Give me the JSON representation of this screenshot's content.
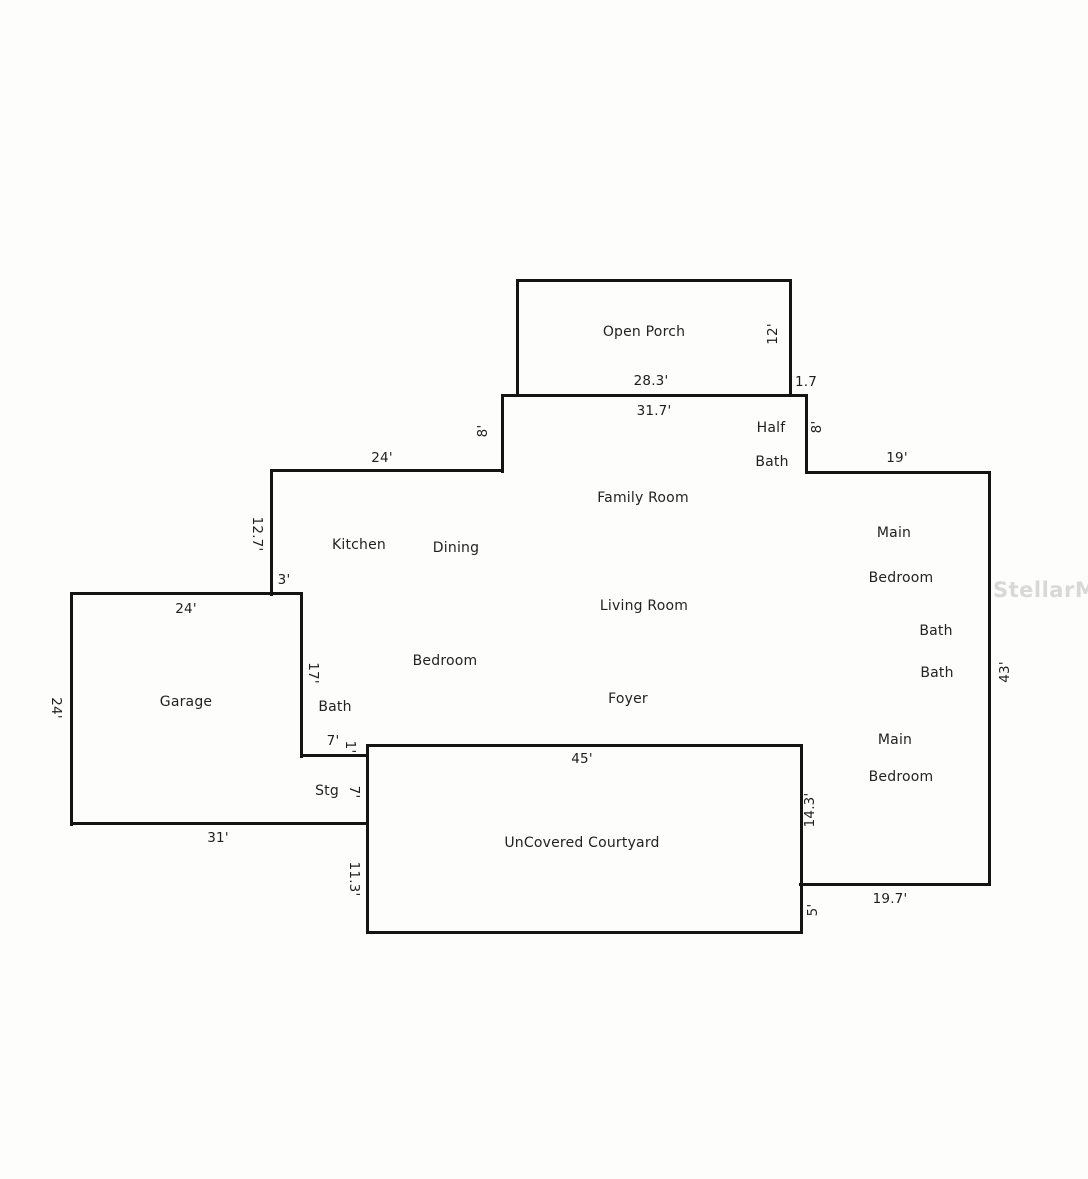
{
  "watermark": "StellarMLS",
  "rooms": {
    "open_porch": "Open Porch",
    "half_bath": [
      "Half",
      "Bath"
    ],
    "family_room": "Family Room",
    "kitchen": "Kitchen",
    "dining": "Dining",
    "living_room": "Living Room",
    "main_bedroom_upper": [
      "Main",
      "Bedroom"
    ],
    "bath_upper": "Bath",
    "bath_lower": "Bath",
    "bedroom": "Bedroom",
    "garage": "Garage",
    "bath_garage": "Bath",
    "foyer": "Foyer",
    "stg": "Stg",
    "main_bedroom_lower": [
      "Main",
      "Bedroom"
    ],
    "courtyard": "UnCovered Courtyard"
  },
  "dims": {
    "porch_width": "28.3'",
    "porch_depth": "12'",
    "porch_offset": "1.7",
    "house_top_width": "31.7'",
    "step_left": "8'",
    "step_right": "8'",
    "kitchen_top": "24'",
    "wing_top": "19'",
    "kitchen_left": "12.7'",
    "jog_3": "3'",
    "garage_top": "24'",
    "garage_left": "24'",
    "garage_bottom": "31'",
    "bath_wall": "17'",
    "bath_width": "7'",
    "jog_1": "1'",
    "stg_height": "7'",
    "right_wall": "43'",
    "courtyard_width": "45'",
    "courtyard_left": "11.3'",
    "courtyard_right": "14.3'",
    "courtyard_step": "5'",
    "bedroom_bottom": "19.7'"
  }
}
